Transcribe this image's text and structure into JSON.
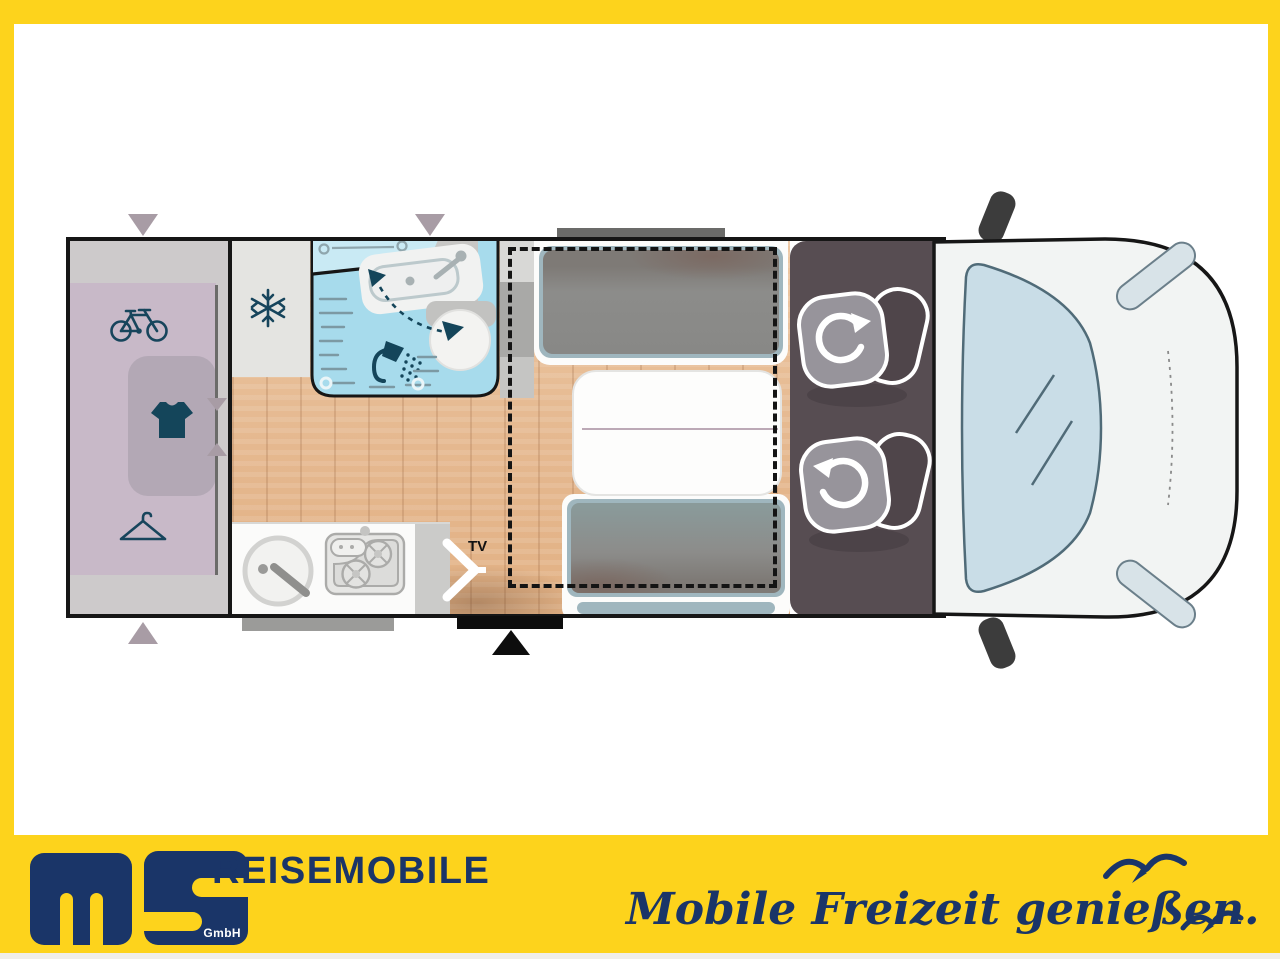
{
  "plan": {
    "tv_label": "TV",
    "areas": [
      {
        "name": "rear-garage",
        "features": [
          "bicycle-storage",
          "wardrobe",
          "clothes-rail"
        ]
      },
      {
        "name": "refrigerator"
      },
      {
        "name": "bathroom",
        "features": [
          "shower",
          "washbasin",
          "swivel-toilet"
        ]
      },
      {
        "name": "kitchen",
        "features": [
          "round-sink",
          "two-burner-stove"
        ]
      },
      {
        "name": "dinette",
        "features": [
          "two-bench-seats",
          "table",
          "drop-down-bed-outline"
        ]
      },
      {
        "name": "cab",
        "features": [
          "driver-swivel-seat",
          "passenger-swivel-seat"
        ]
      },
      {
        "name": "vehicle-front",
        "features": [
          "windshield",
          "mirrors",
          "headlights"
        ]
      }
    ],
    "markers": [
      "window-arrow-left",
      "window-arrow-center",
      "window-arrow-bottom",
      "entrance-door-arrow",
      "roof-window-bar"
    ]
  },
  "footer": {
    "logo_text": "ms",
    "logo_suffix": "GmbH",
    "brand_line": "REISEMOBILE",
    "tagline": "Mobile Freizeit genießen."
  },
  "colors": {
    "frame_yellow": "#FDD31C",
    "brand_navy": "#1A3568",
    "wall_black": "#161616",
    "floor_wood": "#E5B88F",
    "garage_lavender": "#C8B9C8",
    "garage_gray": "#CDCACB",
    "bathroom_blue": "#A7DBEC",
    "icon_teal": "#17455C",
    "bench_gray": "#8C8C8A",
    "backrest_blue_gray": "#9FB6BE",
    "cab_dark": "#574D52",
    "seat_gray": "#97949B",
    "marker_mauve": "#A89CA5",
    "windshield_blue": "#C9DDE7"
  }
}
